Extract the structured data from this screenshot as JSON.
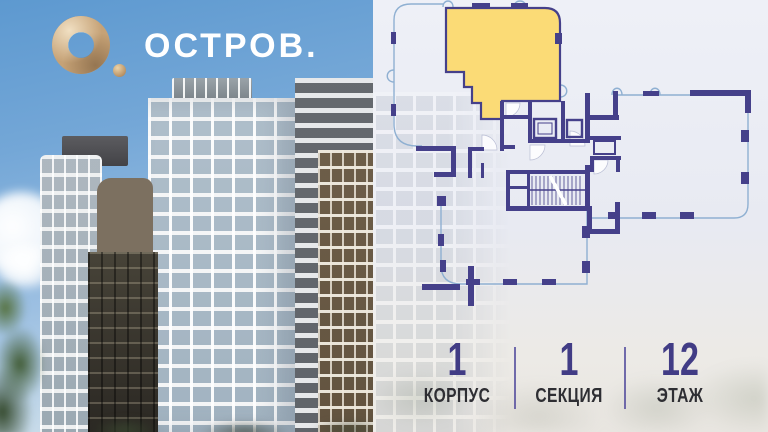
{
  "brand": {
    "name": "ОСТРОВ.",
    "logo_icon": "gold-ring-with-dot",
    "logo_gold": "#c6a276",
    "text_color": "#ffffff"
  },
  "floor_plan": {
    "selected_unit_color": "#fbdb76",
    "wall_color": "#45408a",
    "outline_color": "#8fb0d2",
    "background_color": "#e9ebf2",
    "features": [
      "selected-apartment",
      "staircase",
      "elevators",
      "balcony-outlines"
    ]
  },
  "stats": {
    "value_color": "#413c85",
    "label_color": "#2e2e33",
    "divider_color": "#5a54a0",
    "items": [
      {
        "value": "1",
        "label": "КОРПУС"
      },
      {
        "value": "1",
        "label": "СЕКЦИЯ"
      },
      {
        "value": "12",
        "label": "ЭТАЖ"
      }
    ]
  }
}
